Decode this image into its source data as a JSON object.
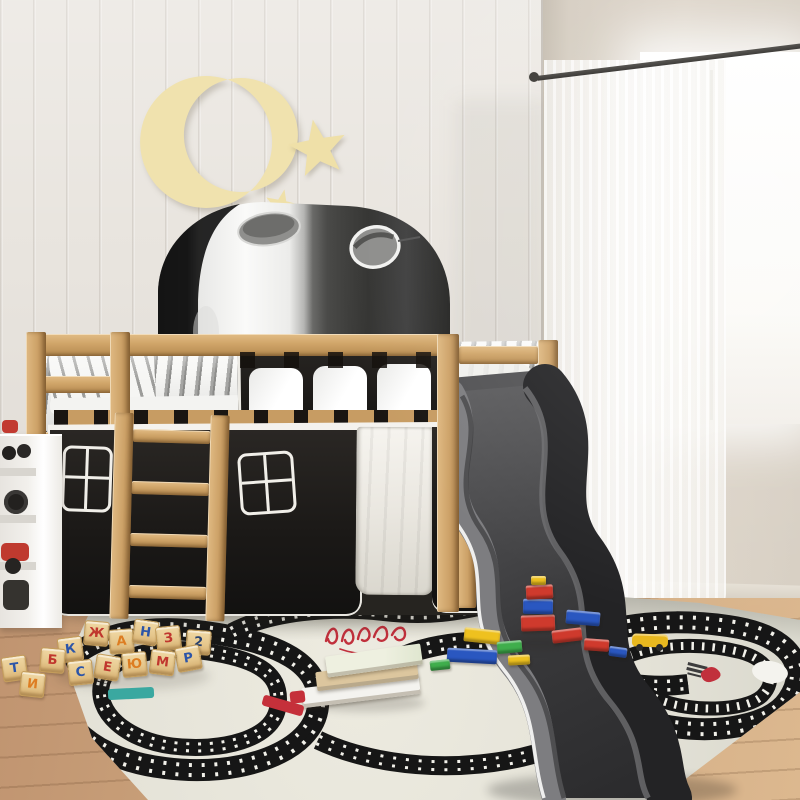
{
  "meta": {
    "title": "Kids' pine loft bed with play tunnel, curtains and slide — bedroom scene"
  },
  "scene": {
    "wall_left": "white beadboard panelling",
    "wall_right": "beige wall with bright window",
    "floor": "light wood planks",
    "decor": {
      "moon": "cream crescent-moon cut-out",
      "stars": [
        "large five-point star",
        "small five-point star"
      ]
    }
  },
  "bed": {
    "material": "solid pine wood",
    "tunnel": {
      "colors": [
        "white",
        "black"
      ],
      "portholes": 2
    },
    "front_panel": {
      "color": "black",
      "windows": 3
    },
    "bedding": "white and grey striped duvet and pillow",
    "under_bed_curtains": {
      "colors": [
        "black",
        "white"
      ],
      "window_cutouts": 3,
      "door_panel": "white"
    },
    "ladder_rungs": 4,
    "slide_color": "dark grey"
  },
  "window": {
    "curtain": "white sheer",
    "rod_color": "dark grey"
  },
  "toys": {
    "alphabet_blocks": [
      "К",
      "Ж",
      "А",
      "Н",
      "З",
      "2",
      "Р",
      "М",
      "Ю",
      "Е",
      "С",
      "Б",
      "Т",
      "И"
    ],
    "blocks_material": "wood",
    "bricks_colors": [
      "red",
      "blue",
      "yellow",
      "green"
    ],
    "books_count": 3,
    "vehicles": [
      "red car",
      "yellow car"
    ]
  },
  "rug": {
    "style": "road race-track play rug",
    "base_color": "#e4e2d7",
    "track_color": "#161616",
    "script_color": "#c1303c"
  },
  "palette": {
    "pine": "#cfa56c",
    "tunnel_black": "#2b2b2b",
    "curtain_black": "#1d1b19",
    "slide_grey": "#3f3f41",
    "wall_panel": "#e9e5df",
    "wall_beige": "#d5cdc1",
    "floor_wood": "#c79f76",
    "moon_cream": "#f0e2ae"
  }
}
